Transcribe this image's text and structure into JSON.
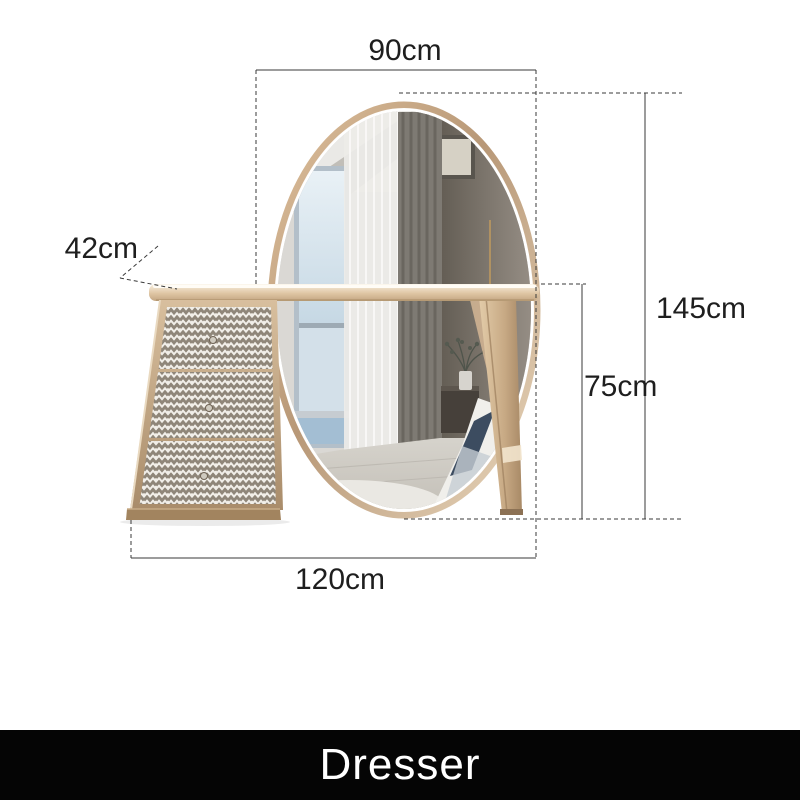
{
  "figure": {
    "kind": "furniture-dimension-diagram",
    "item": "dresser with oval LED mirror and three chevron-pattern drawers",
    "drawer_count": 3
  },
  "dimensions": {
    "mirror_width": "90cm",
    "depth": "42cm",
    "total_height": "145cm",
    "table_height": "75cm",
    "base_width": "120cm"
  },
  "footer": {
    "label": "Dresser"
  },
  "colors": {
    "background": "#ffffff",
    "dimension_line": "#3a3a3a",
    "label_text": "#1e1e1e",
    "frame_champagne": "#c9ab88",
    "chevron": "#8f8679",
    "chevron_bg": "#f1eee8",
    "footer_bg": "#050505",
    "footer_text": "#ffffff"
  }
}
